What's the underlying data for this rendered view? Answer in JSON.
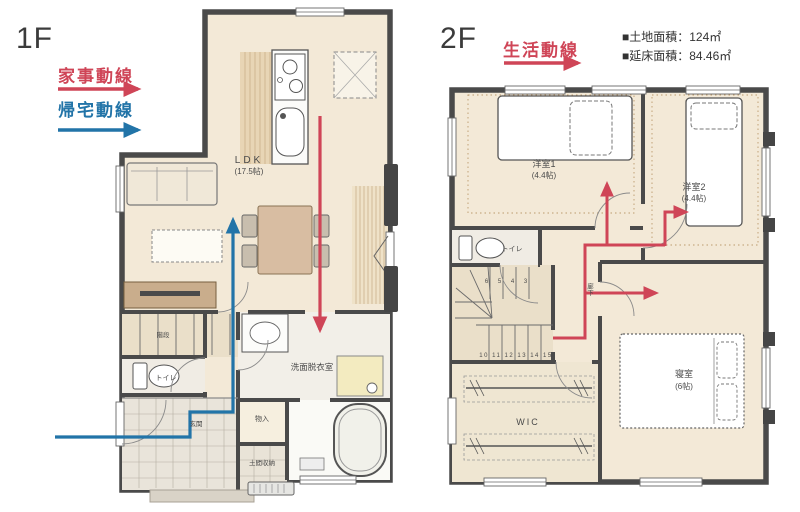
{
  "floor1": {
    "label": "1F",
    "legend": [
      {
        "label": "家事動線",
        "color": "#cf4557"
      },
      {
        "label": "帰宅動線",
        "color": "#2274a8"
      }
    ],
    "rooms": {
      "ldk": "LDK",
      "ldk_size": "(17.5帖)",
      "stairs": "階段",
      "toilet": "トイレ",
      "washroom": "洗面脱衣室",
      "closet": "物入",
      "doma_storage": "土間収納",
      "entrance": "玄関"
    }
  },
  "floor2": {
    "label": "2F",
    "legend": [
      {
        "label": "生活動線",
        "color": "#cf4557"
      }
    ],
    "site_info": [
      "■土地面積：124㎡",
      "■延床面積：84.46㎡"
    ],
    "rooms": {
      "bedroom1": "洋室1",
      "bedroom1_size": "(4.4帖)",
      "bedroom2": "洋室2",
      "bedroom2_size": "(4.4帖)",
      "toilet": "トイレ",
      "hallway": "廊下",
      "master_bedroom": "寝室",
      "master_bedroom_size": "(6帖)",
      "wic": "WIC",
      "stair_numbers_top": "6 5 4 3",
      "stair_numbers_bottom": "10 11 12 13 14 15"
    }
  },
  "colors": {
    "housework_line": "#cf4557",
    "homecoming_line": "#2274a8",
    "living_line": "#cf4557",
    "floor_fill": "#f3e9d7",
    "wall": "#4a4a4a"
  }
}
